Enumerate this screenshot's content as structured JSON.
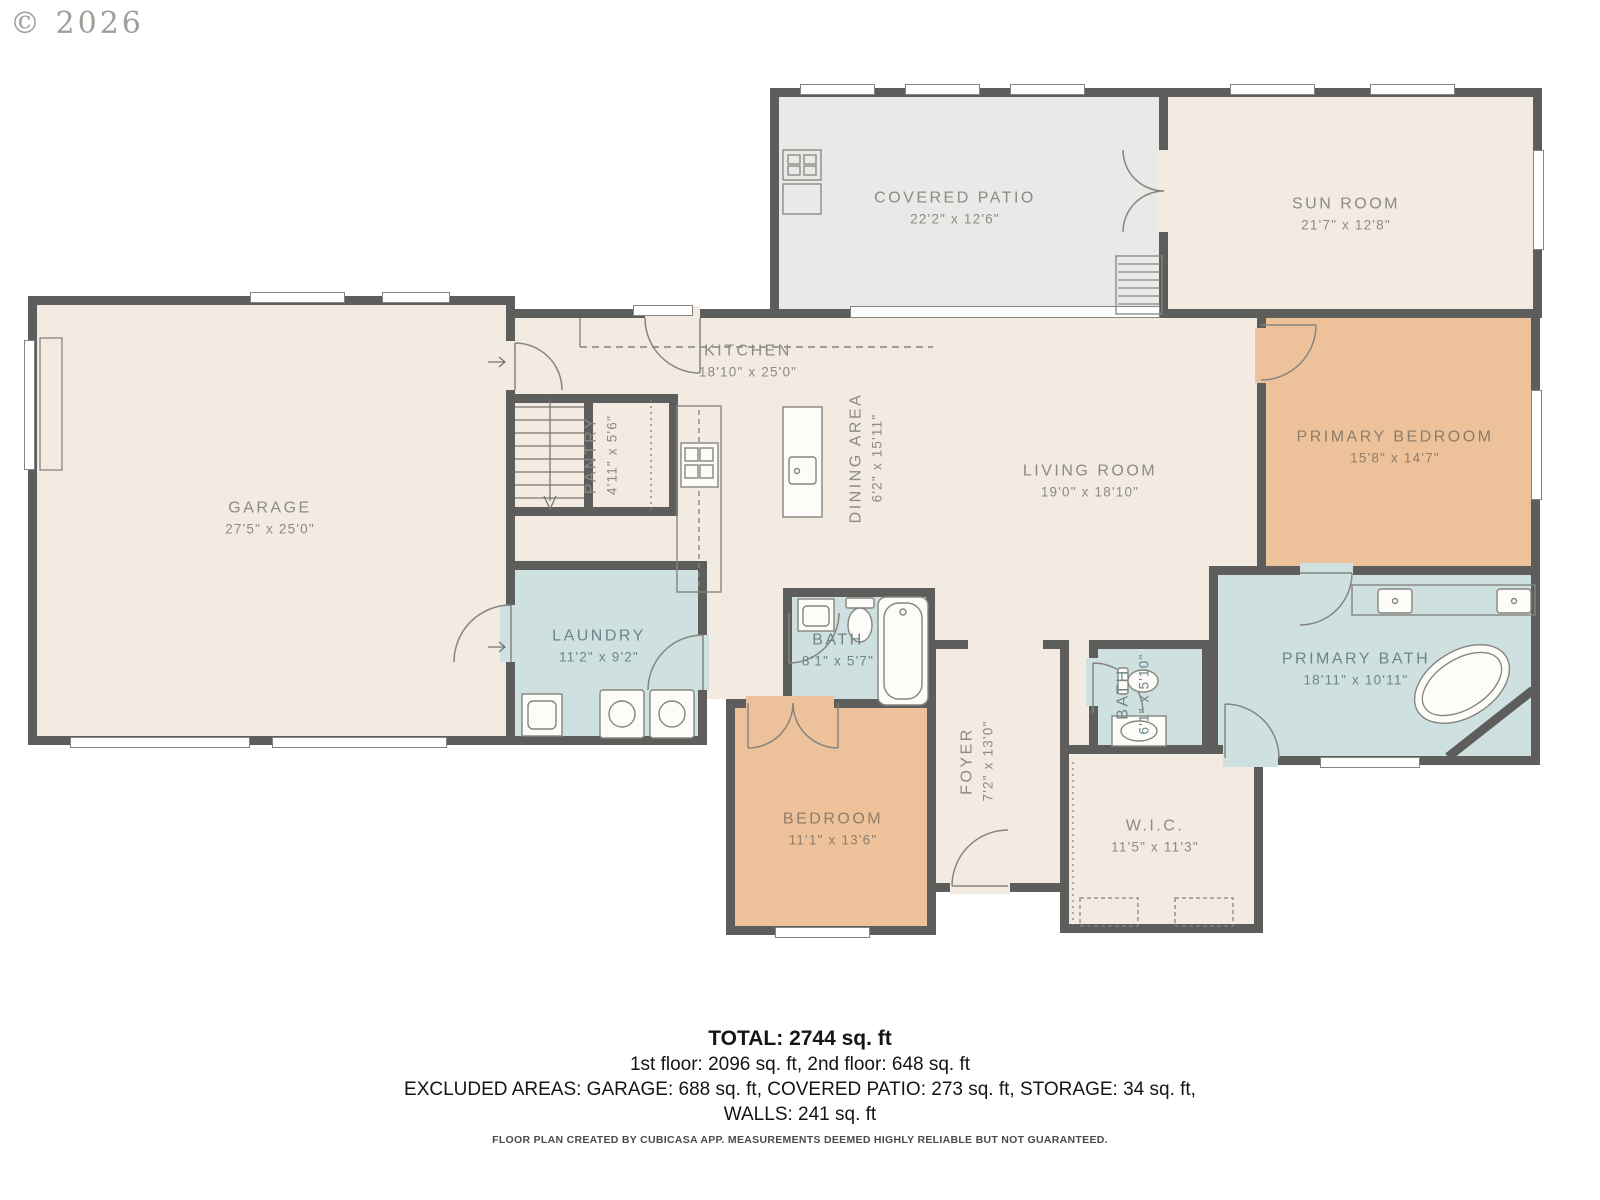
{
  "watermark": "© 2026",
  "rooms": [
    {
      "name": "COVERED PATIO",
      "dims": "22'2\" x 12'6\""
    },
    {
      "name": "SUN ROOM",
      "dims": "21'7\" x 12'8\""
    },
    {
      "name": "KITCHEN",
      "dims": "18'10\" x 25'0\""
    },
    {
      "name": "GARAGE",
      "dims": "27'5\" x 25'0\""
    },
    {
      "name": "PANTRY",
      "dims": "4'11\" x 5'6\""
    },
    {
      "name": "DINING AREA",
      "dims": "6'2\" x 15'11\""
    },
    {
      "name": "LIVING ROOM",
      "dims": "19'0\" x 18'10\""
    },
    {
      "name": "PRIMARY BEDROOM",
      "dims": "15'8\" x 14'7\""
    },
    {
      "name": "LAUNDRY",
      "dims": "11'2\" x 9'2\""
    },
    {
      "name": "BATH",
      "dims": "8'1\" x 5'7\""
    },
    {
      "name": "BATH",
      "dims": "6'1\" x 5'10\""
    },
    {
      "name": "PRIMARY BATH",
      "dims": "18'11\" x 10'11\""
    },
    {
      "name": "BEDROOM",
      "dims": "11'1\" x 13'6\""
    },
    {
      "name": "FOYER",
      "dims": "7'2\" x 13'0\""
    },
    {
      "name": "W.I.C.",
      "dims": "11'5\" x 11'3\""
    }
  ],
  "summary": {
    "total": "TOTAL: 2744 sq. ft",
    "floors": "1st floor: 2096 sq. ft, 2nd floor: 648 sq. ft",
    "excluded": "EXCLUDED AREAS: GARAGE: 688 sq. ft, COVERED PATIO: 273 sq. ft, STORAGE: 34 sq. ft,",
    "walls": "WALLS: 241 sq. ft"
  },
  "footer": "FLOOR PLAN CREATED BY CUBICASA APP. MEASUREMENTS DEEMED HIGHLY RELIABLE BUT NOT GUARANTEED.",
  "colors": {
    "wall": "#5d5d5b",
    "floor": "#f3ebe2",
    "patio": "#e9e9e7",
    "bedroom_fill": "#edc29b",
    "bath_fill": "#cfe0e1"
  }
}
